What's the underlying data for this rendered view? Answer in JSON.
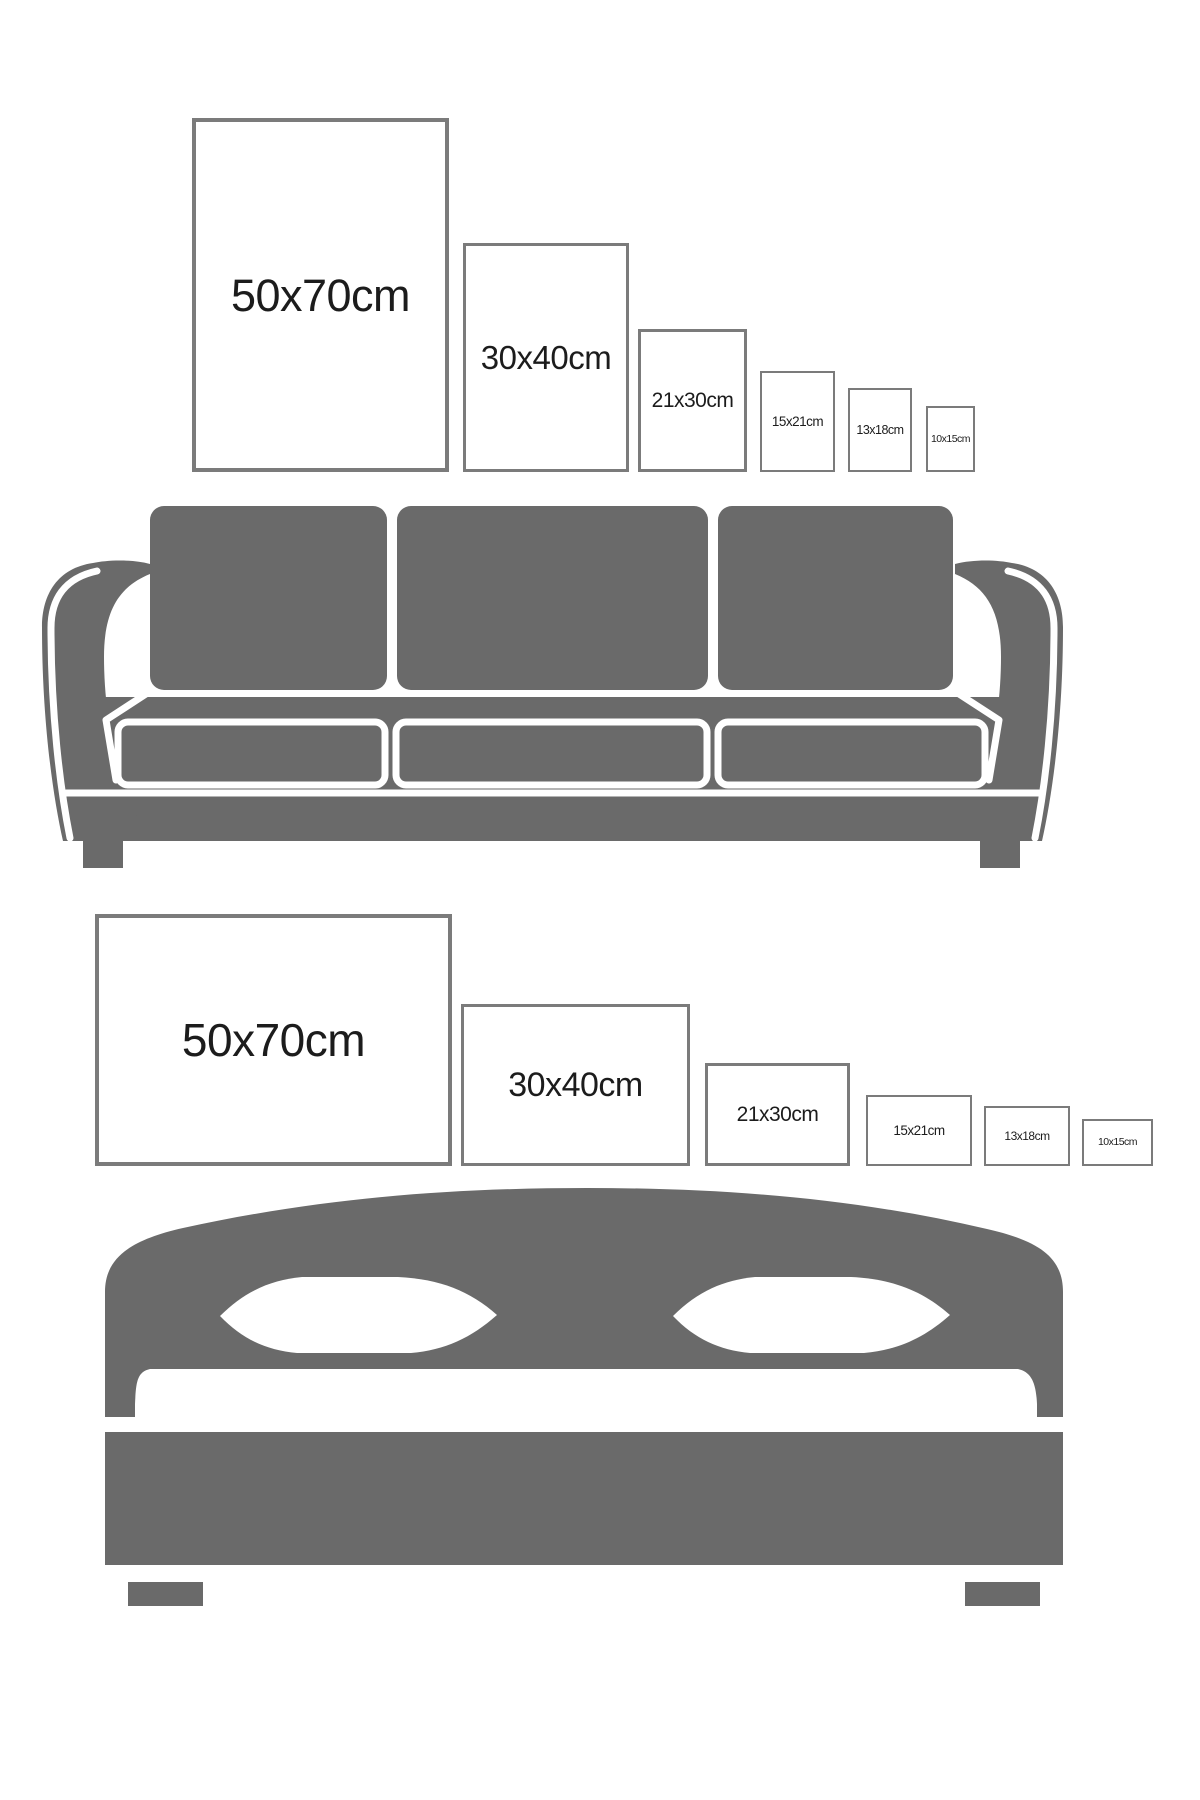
{
  "colors": {
    "furniture_silhouette": "#6a6a6a",
    "frame_border": "#7b7b7b",
    "frame_fill": "#ffffff",
    "label_text": "#1c1c1c",
    "background": "#ffffff"
  },
  "top_section": {
    "furniture": "sofa",
    "orientation": "portrait",
    "frames": [
      {
        "label": "50x70cm"
      },
      {
        "label": "30x40cm"
      },
      {
        "label": "21x30cm"
      },
      {
        "label": "15x21cm"
      },
      {
        "label": "13x18cm"
      },
      {
        "label": "10x15cm"
      }
    ]
  },
  "bottom_section": {
    "furniture": "bed",
    "orientation": "landscape",
    "frames": [
      {
        "label": "50x70cm"
      },
      {
        "label": "30x40cm"
      },
      {
        "label": "21x30cm"
      },
      {
        "label": "15x21cm"
      },
      {
        "label": "13x18cm"
      },
      {
        "label": "10x15cm"
      }
    ]
  }
}
